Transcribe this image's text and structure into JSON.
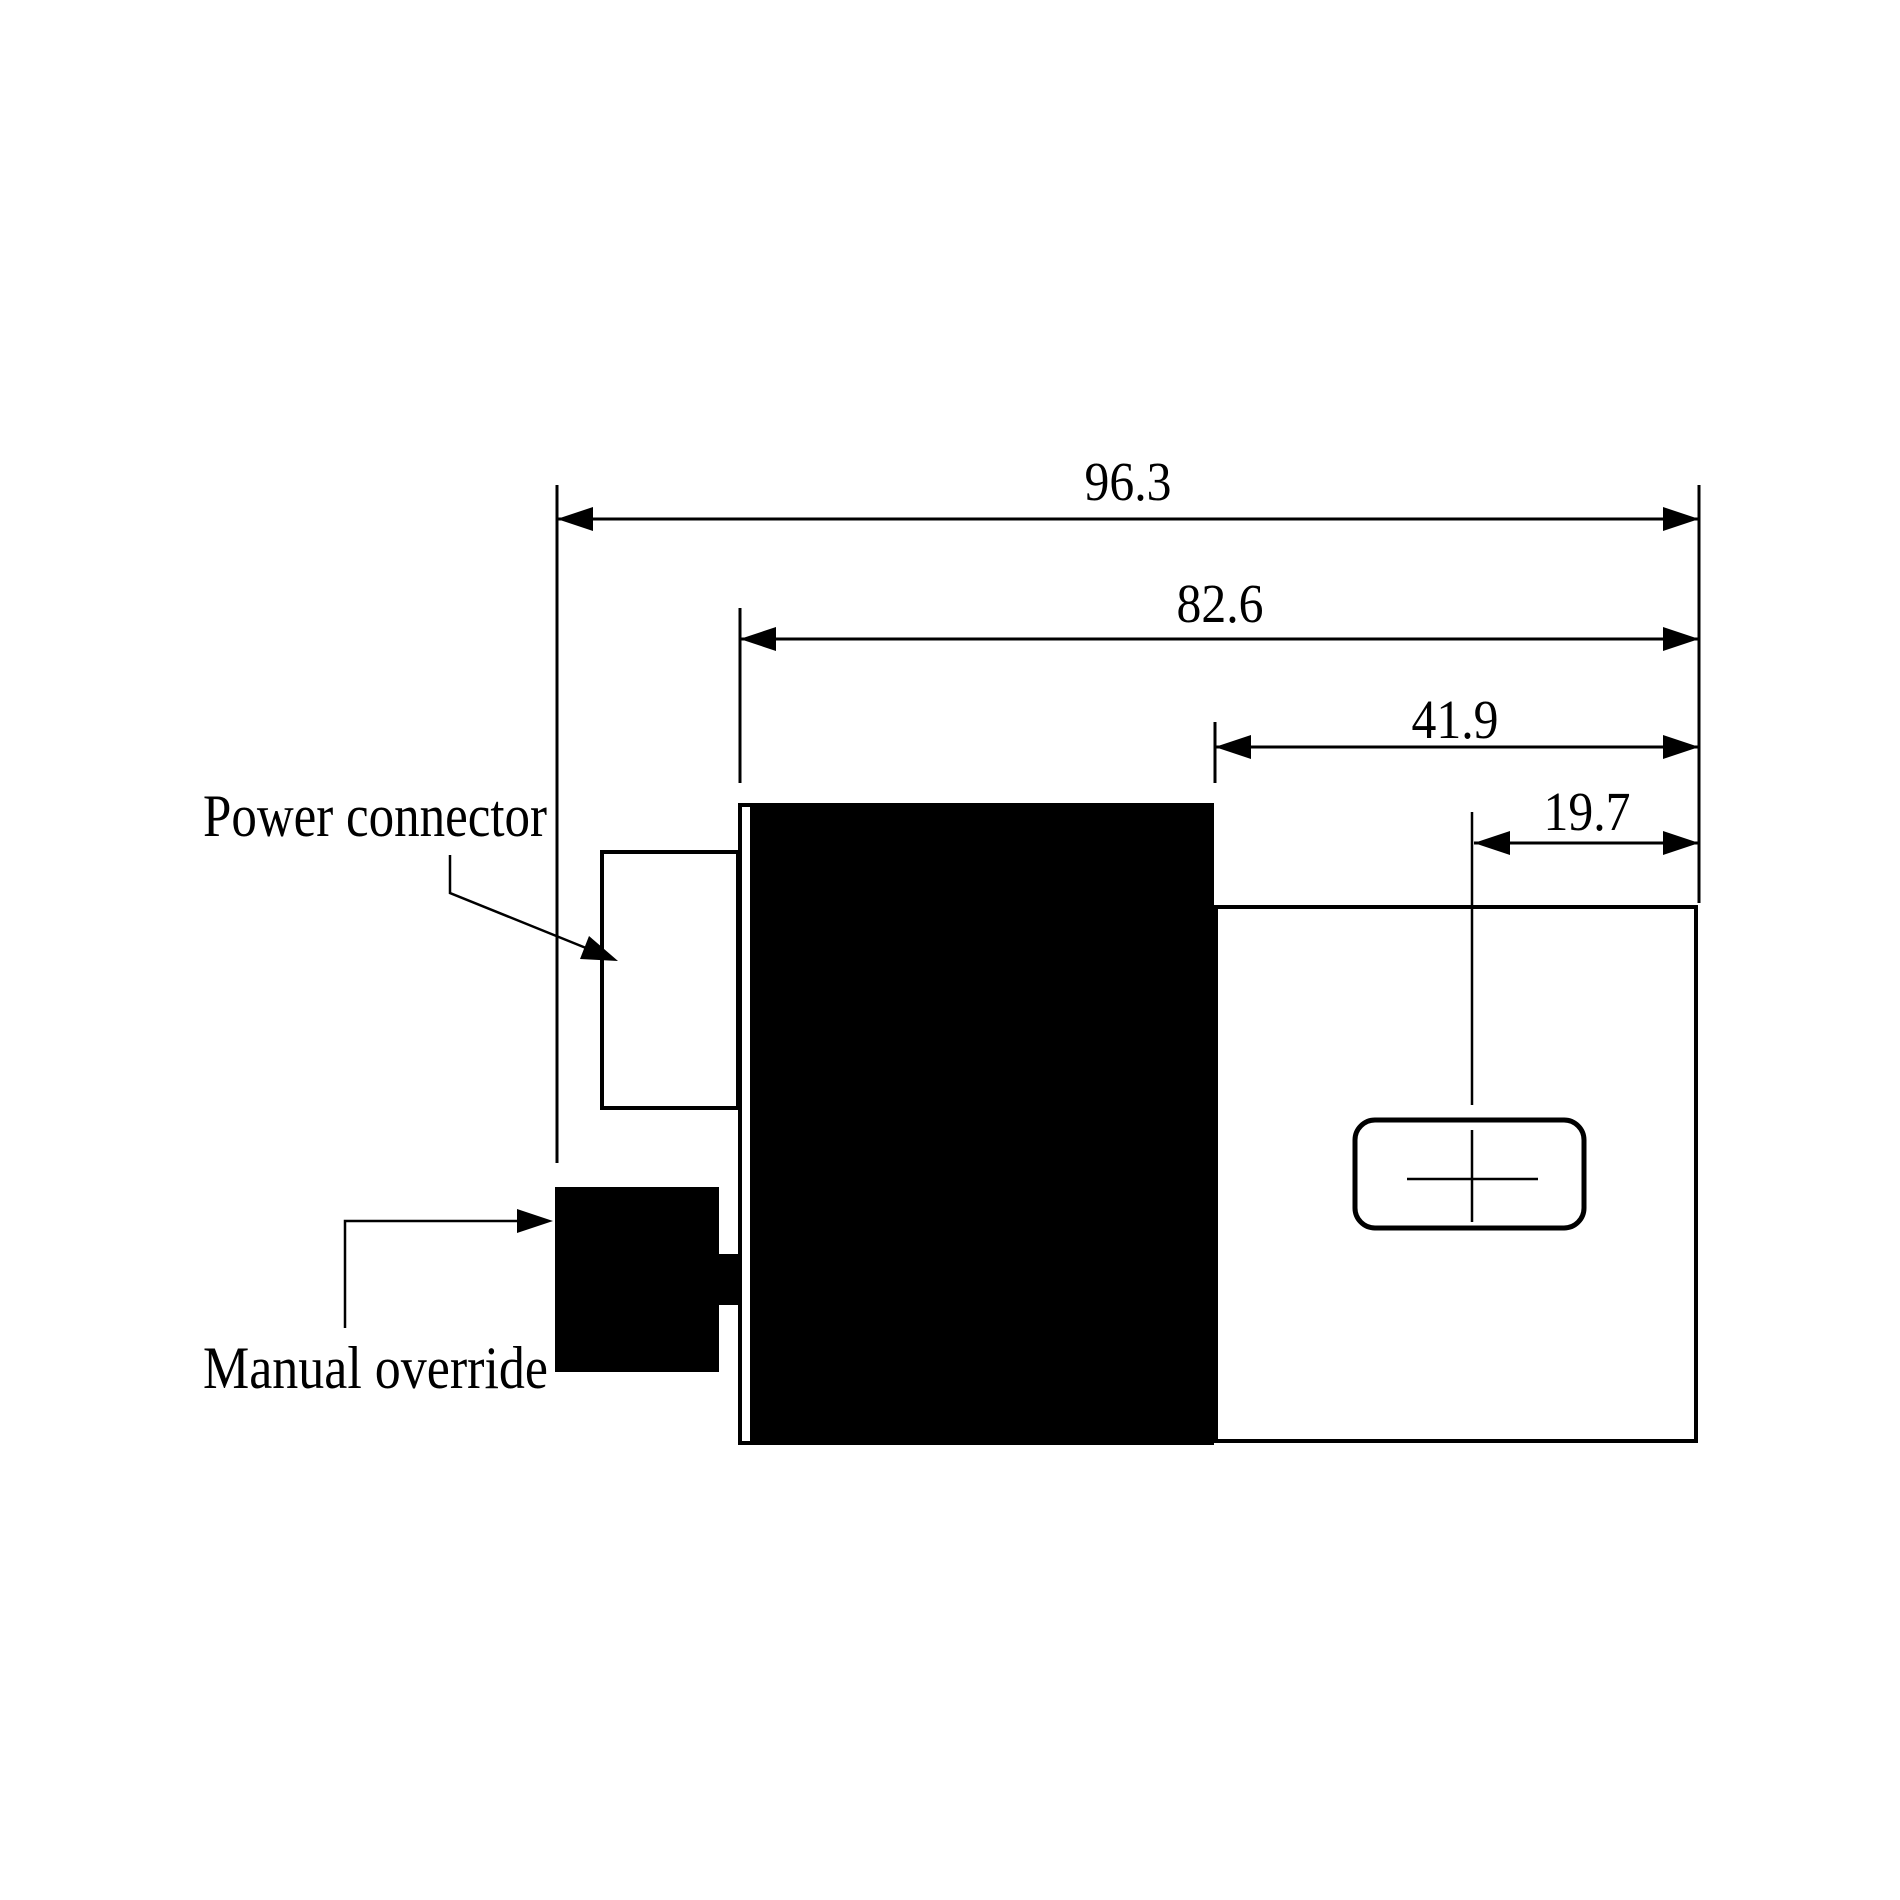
{
  "canvas": {
    "background": "#ffffff",
    "ink": "#000000"
  },
  "figure_type": "engineering-dimension-drawing",
  "dimensions": [
    {
      "name": "overall-length",
      "label": "96.3"
    },
    {
      "name": "coil-section-length",
      "label": "82.6"
    },
    {
      "name": "valve-body-length",
      "label": "41.9"
    },
    {
      "name": "port-center-offset",
      "label": "19.7"
    }
  ],
  "annotations": [
    {
      "name": "power-connector",
      "label": "Power connector"
    },
    {
      "name": "manual-override",
      "label": "Manual override"
    }
  ]
}
